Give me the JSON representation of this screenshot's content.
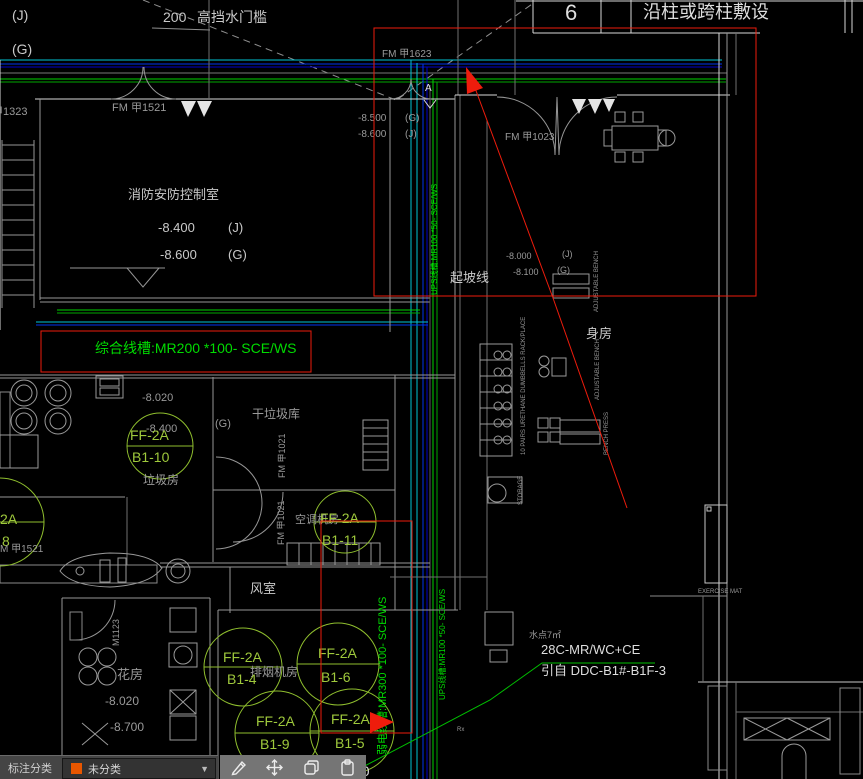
{
  "grid_header": {
    "number": "6",
    "title": "沿柱或跨柱敷设"
  },
  "top": {
    "dim": "200",
    "dim_label": "高挡水门槛",
    "axis_j": "(J)",
    "axis_g": "(G)",
    "door_left": "甲1323",
    "door_fm1521": "FM 甲1521",
    "door_fm1623": "FM 甲1623",
    "level_a": "-8.500",
    "level_b": "-8.600",
    "axis_g2": "(G)",
    "axis_j2": "(J)",
    "section_mark": "A"
  },
  "control_room": {
    "name": "消防安防控制室",
    "level_a": "-8.400",
    "axis_a": "(J)",
    "level_b": "-8.600",
    "axis_b": "(G)"
  },
  "tray_box": {
    "label": "综合线槽:MR200 *100- SCE/WS"
  },
  "garbage": {
    "level": "-8.020",
    "level2": "-8.400",
    "fan_top": "FF-2A",
    "fan_bot": "B1-10",
    "room": "垃圾房",
    "axis": "(G)"
  },
  "mid_rooms": {
    "dry_garbage": "干垃圾库",
    "door_tag1": "FM 甲1021",
    "door_tag2": "FM 甲1021",
    "ac_room": "空调机房",
    "fan_top": "FF-2A",
    "fan_bot": "B1-11",
    "wind_room": "风室",
    "smoke_room": "排烟机房"
  },
  "gym": {
    "door": "FM 甲1023",
    "slope": "起坡线",
    "level_a": "-8.000",
    "level_b": "-8.100",
    "axis_a": "(J)",
    "axis_b": "(G)",
    "room": "身房",
    "rack_label": "10 PAIRS URETHANE DUMBBELLS RACK/PLACE",
    "bench1": "ADJUSTABLE BENCH",
    "bench2": "ADJUSTABLE BENCH",
    "bench3": "BENCH PRESS",
    "storage": "STORAGE",
    "mat": "EXERCISE MAT",
    "rx": "Rx"
  },
  "trays": {
    "weak": "弱电线槽:MR300 *100- SCE/WS",
    "ups1": "UPS线槽:MR100 *50- SCE/WS",
    "ups2": "UPS线槽:MR100 *50- SCE/WS"
  },
  "fans": {
    "b14_top": "FF-2A",
    "b14_bot": "B1-4",
    "b16_top": "FF-2A",
    "b16_bot": "B1-6",
    "b19_top": "FF-2A",
    "b19_bot": "B1-9",
    "b15_top": "FF-2A",
    "b15_bot": "B1-5",
    "b18_top": "2A",
    "b18_bot": "8"
  },
  "flower": {
    "door_tag": "M 甲1521",
    "door": "M1123",
    "room": "花房",
    "level_a": "-8.020",
    "level_b": "-8.700"
  },
  "feeder": {
    "water": "水点7㎡",
    "line1": "28C-MR/WC+CE",
    "line2": "引自 DDC-B1#-B1F-3"
  },
  "fragment": "00",
  "toolbar": {
    "category_label": "标注分类",
    "category_value": "未分类",
    "caret": "▼"
  },
  "colors": {
    "cyan": "#00c3d4",
    "blue": "#0033ee",
    "blue_dark": "#0000cc",
    "green": "#00d400",
    "lime": "#8fbe2e",
    "red": "#ee1c0c",
    "orange": "#e85d00",
    "grey": "#9a9a9a",
    "white": "#d9d9d9"
  }
}
